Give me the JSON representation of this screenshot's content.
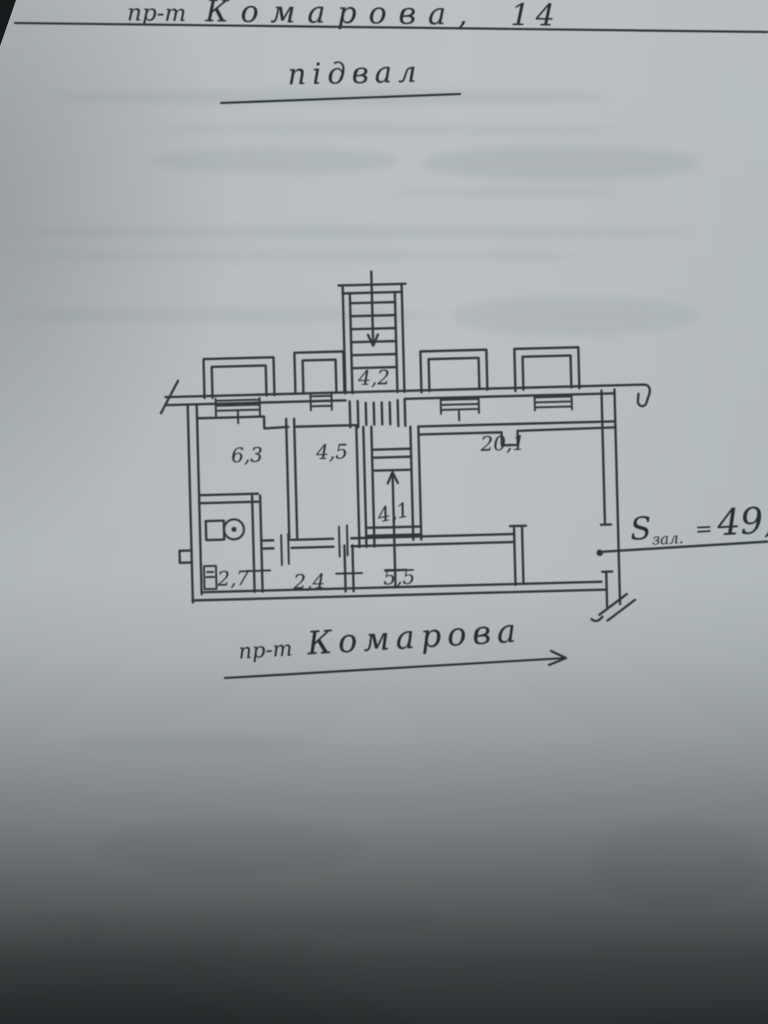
{
  "document": {
    "title": {
      "prefix": "пр-т",
      "name": "Комарова,",
      "number": "14"
    },
    "floor_label": "підвал",
    "street_annotation": {
      "prefix": "пр-т",
      "name": "Комарова"
    },
    "hall_area_annotation": {
      "symbol": "S",
      "subscript": "зал.",
      "equals": "=",
      "value": "49,"
    }
  },
  "plan": {
    "room_areas": [
      {
        "label": "4,2"
      },
      {
        "label": "6,3"
      },
      {
        "label": "4,5"
      },
      {
        "label": "20,1"
      },
      {
        "label": "4,1"
      },
      {
        "label": "2,7"
      },
      {
        "label": "2,4"
      },
      {
        "label": "5,5"
      }
    ]
  },
  "colors": {
    "ink": "#30363b",
    "paper": "#b6bcbe",
    "photo_shadow": "#1a1e1f"
  }
}
